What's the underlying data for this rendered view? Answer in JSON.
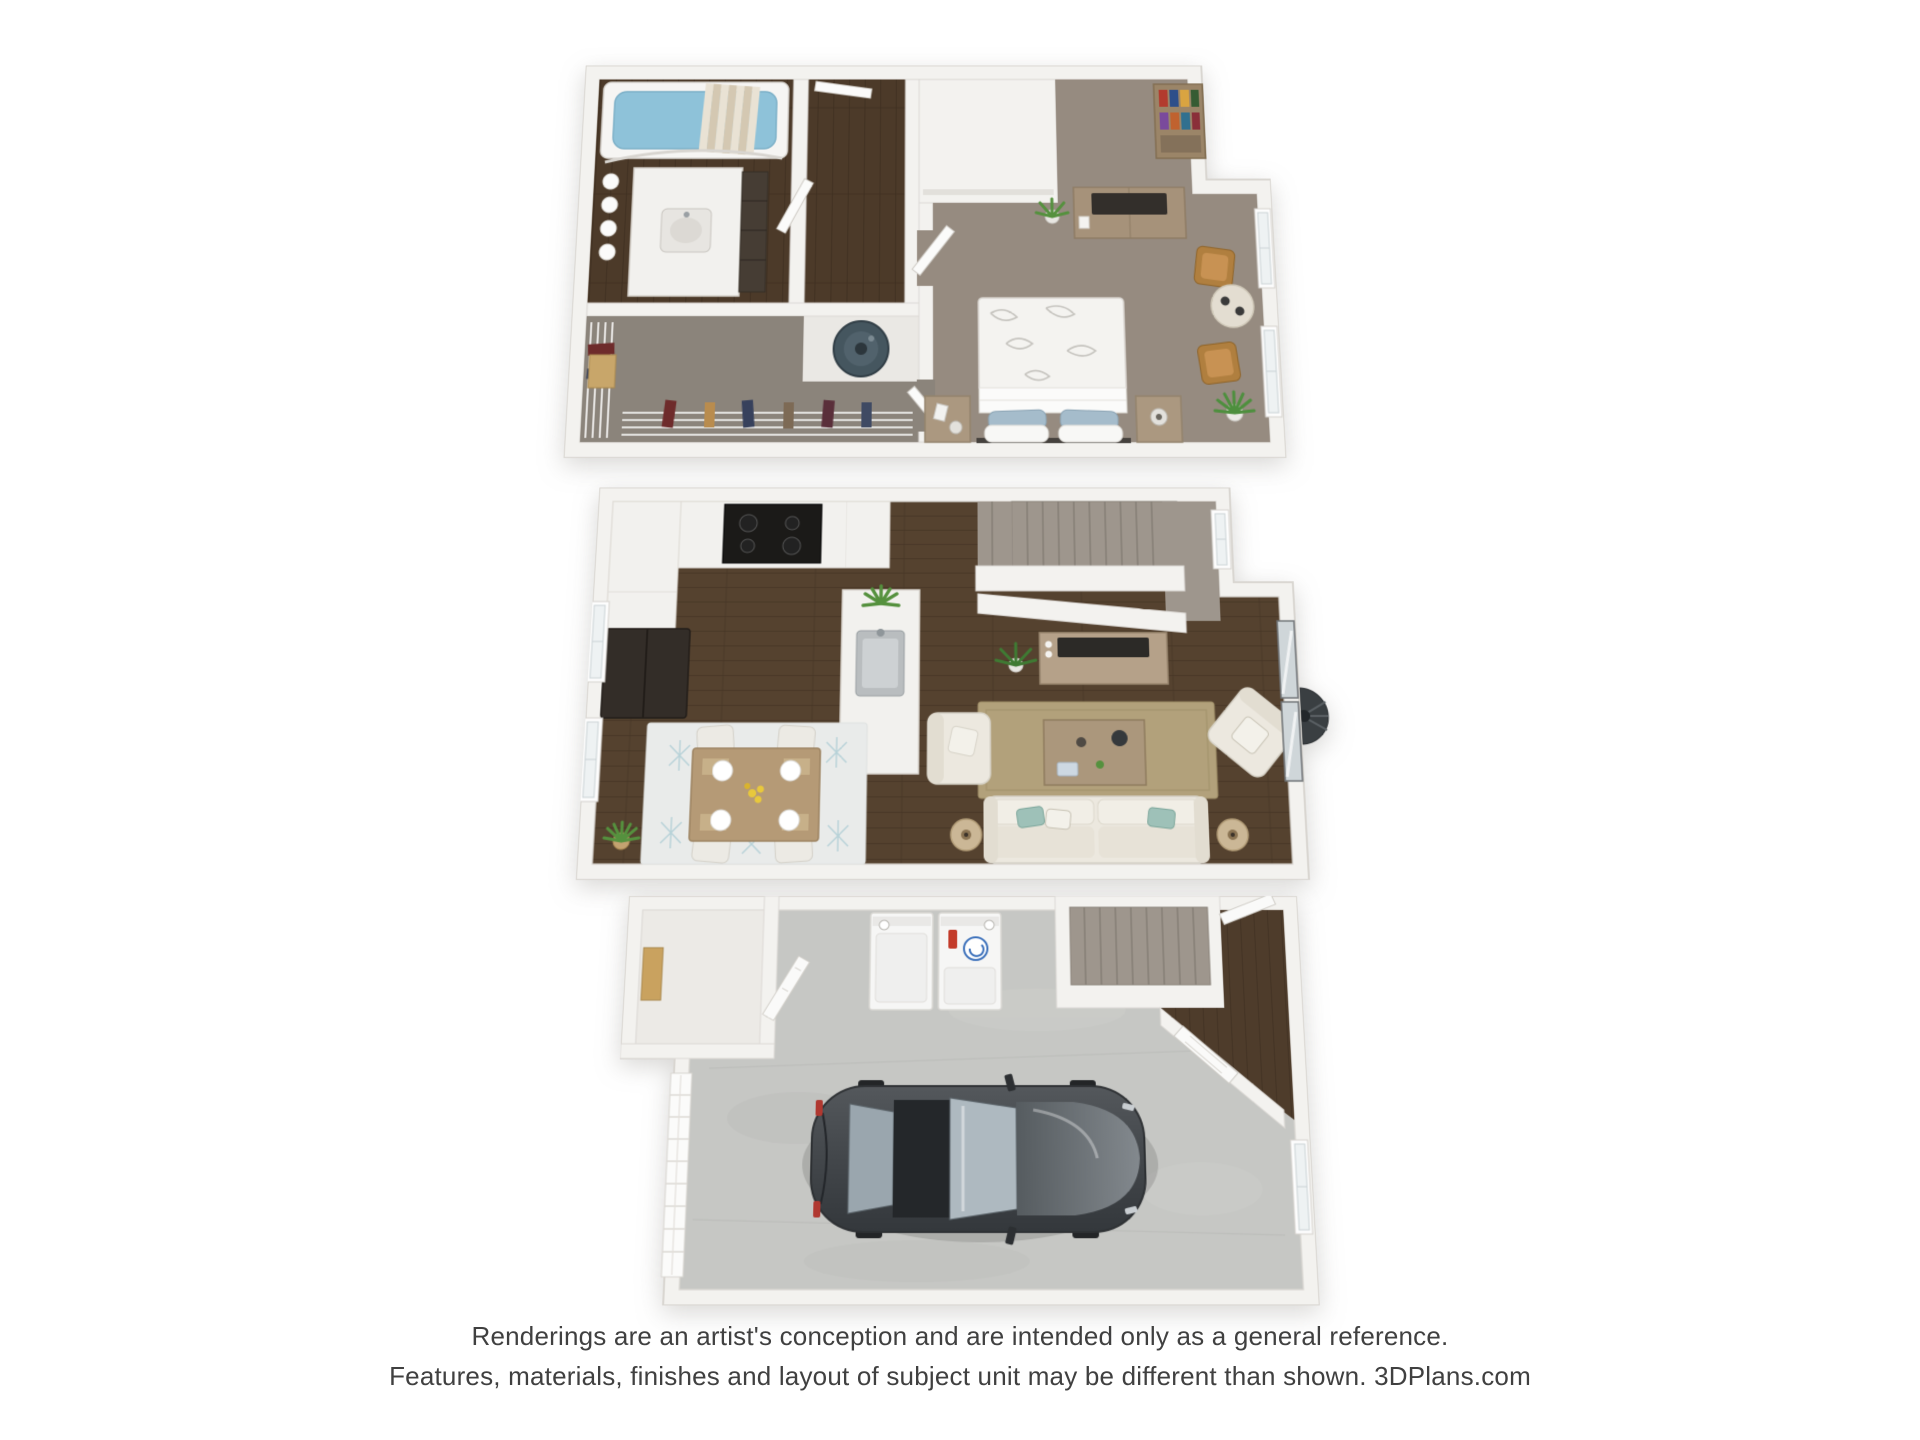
{
  "disclaimer": {
    "line1": "Renderings are an artist's conception and are intended only as a general reference.",
    "line2": "Features, materials, finishes and layout of subject unit may be different than shown. 3DPlans.com"
  },
  "floors": [
    {
      "id": "third-floor-plan",
      "rooms": [
        "bathroom",
        "hallway",
        "water-heater-closet",
        "walk-in-closet",
        "bedroom"
      ],
      "furnishings": [
        "bathtub",
        "vanity-sink",
        "rolled-towels",
        "water-heater",
        "wire-shelving-with-clothes",
        "queen-bed",
        "nightstand",
        "dresser-with-tv",
        "bookcase",
        "accent-chairs",
        "round-side-table",
        "potted-plants",
        "windows"
      ]
    },
    {
      "id": "second-floor-plan",
      "rooms": [
        "kitchen",
        "dining-area",
        "living-room",
        "staircase",
        "upper-hall"
      ],
      "furnishings": [
        "range-cooktop",
        "refrigerator",
        "kitchen-island-sink",
        "dining-table-four-chairs",
        "patterned-rug",
        "sofa",
        "armchairs",
        "coffee-table",
        "tv-console",
        "floor-lamps",
        "jute-rug",
        "sliding-glass-door",
        "patio-fan",
        "potted-plants",
        "windows"
      ]
    },
    {
      "id": "first-floor-plan",
      "rooms": [
        "garage",
        "laundry-area",
        "storage-closet",
        "entry",
        "staircase"
      ],
      "furnishings": [
        "sedan-car",
        "dryer",
        "washer-with-detergent",
        "garage-door-panels",
        "entry-door",
        "window"
      ]
    }
  ],
  "colors": {
    "background": "#ffffff",
    "text": "#404040",
    "wall": "#f3f2ef",
    "wall_edge": "#d9d6d1",
    "wood_dark": "#55422f",
    "wood_hall": "#4c3a29",
    "carpet_bedroom": "#968b80",
    "carpet_closet": "#8b847b",
    "carpet_stairs": "#9e968d",
    "concrete": "#c6c7c4",
    "tub_water": "#8ec2d9",
    "rug_living": "#b2a17b",
    "rug_dining": "#e9ebea",
    "sofa_cream": "#ece8df",
    "furniture_wood": "#ab9880",
    "tv_black": "#2c2a27",
    "plant_green": "#55913e",
    "water_heater": "#45565f",
    "car_body": "#43474b",
    "car_glass": "#aeb9c0",
    "pillow_blue": "#a5bccb",
    "chair_wood": "#b07f3f",
    "appliance_white": "#f6f6f5",
    "detergent_red": "#c33b2a"
  }
}
